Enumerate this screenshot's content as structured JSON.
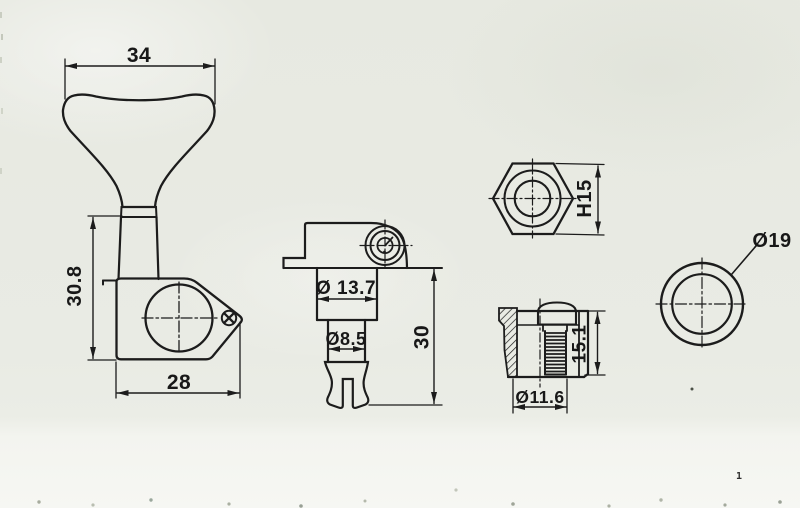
{
  "page": {
    "kind": "technical drawing of bass guitar machine head (tuner) parts",
    "paper_color": "#e9ebe4",
    "paper_bottom_color": "#f6f7f3",
    "line_color": "#1c1c1c"
  },
  "views": {
    "key_front": "tuning key (button) front view",
    "body_front": "gear housing front view",
    "tuner_side": "tuner assembly side view",
    "hex_nut": "hex nut top view",
    "bushing": "threaded bushing section view",
    "washer": "washer top view"
  },
  "labels": {
    "key_width": "34",
    "body_height": "30.8",
    "body_width": "28",
    "cap_diameter": "Ø 13.7",
    "post_diameter": "Ø8.5",
    "side_height": "30",
    "nut_height": "H15",
    "bushing_height": "15.1",
    "bushing_diameter": "Ø11.6",
    "washer_diameter": "Ø19",
    "stray_mark": "1"
  }
}
